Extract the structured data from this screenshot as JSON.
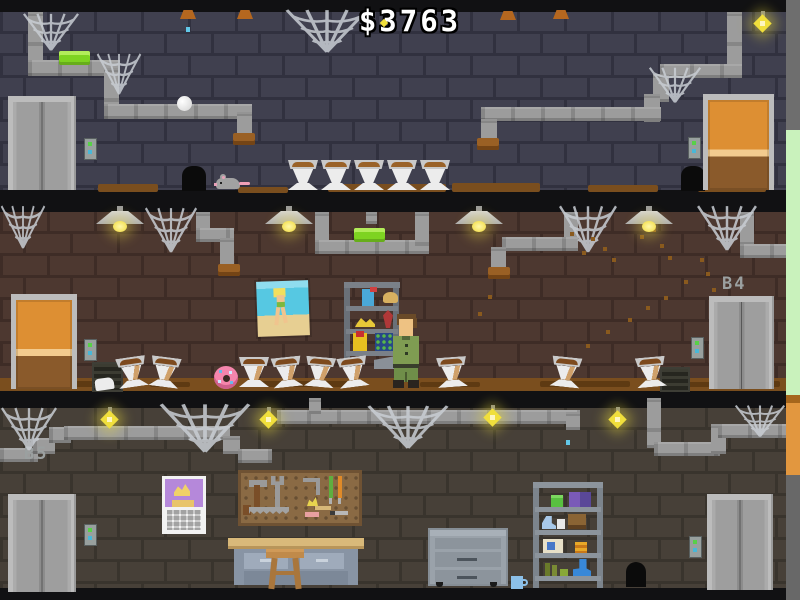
{
  "hud": {
    "money": "$3763"
  },
  "labels": {
    "b4": "B4",
    "b5": "B5"
  },
  "colors": {
    "money_white": "#ffffff",
    "soap_green": "#7ed321",
    "door_orange": "#dd8f33",
    "web_gray": "#c9ced4",
    "bulb_yellow": "#f0df3c",
    "pipe_gray": "#9c9c9c",
    "dirt_brown": "#7a4e1e",
    "outside_green": "#c9f2bc",
    "outside_orange": "#e2973f",
    "label_gray": "#9ba0a0"
  },
  "scene": {
    "walls": [
      {
        "top": 12,
        "height": 178,
        "brick": "#40404f",
        "mortar": "#31313f"
      },
      {
        "top": 212,
        "height": 166,
        "brick": "#4d3830",
        "mortar": "#3e2c26"
      },
      {
        "top": 408,
        "height": 180,
        "brick": "#474038",
        "mortar": "#39342d"
      }
    ],
    "bands": [
      [
        0,
        12
      ],
      [
        190,
        22
      ],
      [
        390,
        18
      ],
      [
        588,
        12
      ]
    ],
    "outside_strip": [
      {
        "top": 0,
        "height": 130,
        "color": "#6e6e6e"
      },
      {
        "top": 130,
        "height": 265,
        "color": "#c9f2bc"
      },
      {
        "top": 395,
        "height": 8,
        "color": "#a5661c"
      },
      {
        "top": 403,
        "height": 72,
        "color": "#e2973f"
      },
      {
        "top": 475,
        "height": 125,
        "color": "#686868"
      }
    ],
    "pipes": [
      [
        28,
        12,
        15,
        56
      ],
      [
        28,
        60,
        92,
        16
      ],
      [
        104,
        68,
        15,
        50
      ],
      [
        104,
        104,
        148,
        15
      ],
      [
        237,
        112,
        15,
        26
      ],
      [
        727,
        12,
        15,
        62
      ],
      [
        660,
        64,
        82,
        14
      ],
      [
        653,
        74,
        16,
        28
      ],
      [
        644,
        94,
        16,
        28
      ],
      [
        481,
        107,
        180,
        14
      ],
      [
        481,
        119,
        16,
        24
      ],
      [
        196,
        212,
        14,
        28
      ],
      [
        196,
        228,
        38,
        14
      ],
      [
        220,
        238,
        14,
        30
      ],
      [
        315,
        212,
        14,
        42
      ],
      [
        315,
        240,
        114,
        14
      ],
      [
        415,
        212,
        14,
        42
      ],
      [
        366,
        212,
        11,
        12
      ],
      [
        564,
        212,
        14,
        38
      ],
      [
        502,
        237,
        76,
        14
      ],
      [
        491,
        247,
        15,
        24
      ],
      [
        740,
        212,
        14,
        38
      ],
      [
        740,
        244,
        46,
        14
      ],
      [
        0,
        448,
        38,
        14
      ],
      [
        33,
        438,
        22,
        16
      ],
      [
        49,
        427,
        22,
        16
      ],
      [
        64,
        426,
        166,
        14
      ],
      [
        223,
        436,
        17,
        18
      ],
      [
        238,
        449,
        34,
        14
      ],
      [
        277,
        410,
        303,
        14
      ],
      [
        309,
        398,
        12,
        16
      ],
      [
        566,
        412,
        14,
        18
      ],
      [
        647,
        398,
        14,
        50
      ],
      [
        654,
        442,
        66,
        14
      ],
      [
        711,
        424,
        15,
        30
      ],
      [
        718,
        424,
        68,
        14
      ]
    ],
    "pipe_caps": [
      [
        233,
        133
      ],
      [
        477,
        138
      ],
      [
        218,
        264
      ],
      [
        488,
        267
      ]
    ],
    "ceiling_caps": [
      [
        180,
        10
      ],
      [
        237,
        10
      ],
      [
        500,
        11
      ],
      [
        553,
        10
      ]
    ],
    "webs": [
      [
        22,
        12,
        58,
        40
      ],
      [
        96,
        52,
        46,
        44
      ],
      [
        284,
        8,
        86,
        46
      ],
      [
        648,
        66,
        54,
        38
      ],
      [
        0,
        204,
        46,
        46
      ],
      [
        144,
        206,
        54,
        48
      ],
      [
        558,
        204,
        60,
        50
      ],
      [
        696,
        204,
        62,
        48
      ],
      [
        0,
        406,
        58,
        46
      ],
      [
        158,
        402,
        94,
        52
      ],
      [
        366,
        404,
        84,
        46
      ],
      [
        734,
        404,
        52,
        34
      ]
    ],
    "bulbs": [
      [
        753,
        11
      ],
      [
        100,
        407
      ],
      [
        259,
        407
      ],
      [
        483,
        405
      ],
      [
        608,
        407
      ]
    ],
    "lamps": [
      [
        96,
        206
      ],
      [
        265,
        206
      ],
      [
        455,
        206
      ],
      [
        625,
        206
      ]
    ],
    "toilets": {
      "floor1": {
        "y": 160,
        "xs": [
          288,
          321,
          354,
          387,
          420
        ],
        "dirty": false
      },
      "floor2": {
        "y": 357,
        "xs": [
          117,
          150,
          239,
          272,
          305,
          338,
          437,
          551,
          636
        ],
        "tilts": [
          -8,
          7,
          0,
          -6,
          5,
          -7,
          -4,
          6,
          -5
        ],
        "dirty": true
      }
    },
    "specks": [
      [
        591,
        237
      ],
      [
        603,
        247
      ],
      [
        612,
        258
      ],
      [
        582,
        251
      ],
      [
        570,
        232
      ],
      [
        640,
        235
      ],
      [
        652,
        228
      ],
      [
        660,
        244
      ],
      [
        668,
        256
      ],
      [
        700,
        258
      ],
      [
        706,
        272
      ],
      [
        712,
        288
      ],
      [
        684,
        280
      ],
      [
        664,
        296
      ],
      [
        646,
        306
      ],
      [
        628,
        318
      ],
      [
        606,
        330
      ],
      [
        586,
        344
      ],
      [
        570,
        368
      ],
      [
        642,
        368
      ],
      [
        488,
        295
      ],
      [
        478,
        312
      ]
    ],
    "dirt_floor1": [
      [
        98,
        184,
        60,
        8
      ],
      [
        238,
        187,
        50,
        6
      ],
      [
        328,
        184,
        118,
        8
      ],
      [
        452,
        183,
        88,
        9
      ],
      [
        588,
        185,
        70,
        7
      ],
      [
        698,
        184,
        68,
        8
      ]
    ],
    "dirt_floor2_strip": [
      0,
      378,
      786,
      13
    ],
    "dirt_floor2_patches": [
      [
        40,
        381,
        70,
        6
      ],
      [
        150,
        382,
        40,
        5
      ],
      [
        250,
        381,
        110,
        6
      ],
      [
        420,
        382,
        60,
        5
      ],
      [
        540,
        381,
        90,
        6
      ],
      [
        660,
        382,
        70,
        5
      ],
      [
        740,
        381,
        40,
        6
      ]
    ],
    "drips": [
      [
        186,
        27
      ],
      [
        566,
        440
      ]
    ],
    "sparkle": [
      381,
      20
    ],
    "holes": [
      [
        182,
        166,
        24,
        25
      ],
      [
        681,
        166,
        24,
        25
      ],
      [
        626,
        562,
        20,
        25
      ]
    ],
    "vents": [
      [
        92,
        362,
        27,
        26
      ],
      [
        660,
        367,
        26,
        21
      ]
    ],
    "elevators": [
      [
        8,
        96,
        68,
        94
      ],
      [
        709,
        296,
        65,
        93
      ],
      [
        8,
        494,
        68,
        98
      ],
      [
        707,
        494,
        66,
        96
      ]
    ],
    "wood_doors": [
      [
        703,
        94,
        71,
        96
      ],
      [
        11,
        294,
        66,
        95
      ]
    ],
    "call_buttons": [
      [
        84,
        138
      ],
      [
        688,
        137
      ],
      [
        84,
        339
      ],
      [
        691,
        337
      ],
      [
        84,
        524
      ],
      [
        689,
        536
      ]
    ],
    "soaps": [
      [
        59,
        51
      ],
      [
        354,
        228
      ]
    ]
  }
}
